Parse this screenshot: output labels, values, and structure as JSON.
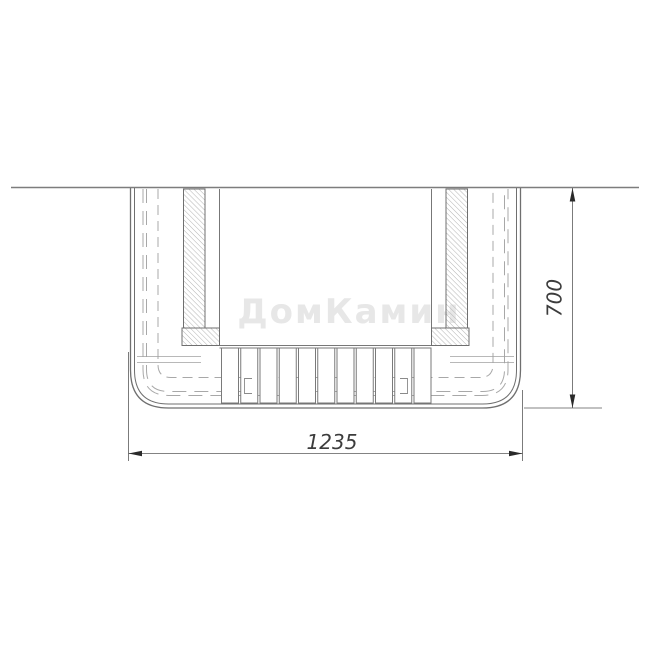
{
  "drawing": {
    "watermark_text": "ДомКамин",
    "dimensions": {
      "width_value": "1235",
      "height_value": "700"
    },
    "colors": {
      "background": "#ffffff",
      "outline": "#6f6f6f",
      "secondary_line": "#8a8a8a",
      "hidden_dashed": "#a8a8a8",
      "hatch": "#b2b2b2",
      "dimension_line": "#5a5a5a",
      "arrow": "#2a2a2a",
      "dimension_text": "#3c3c3c",
      "watermark": "#e7e7e7"
    }
  }
}
